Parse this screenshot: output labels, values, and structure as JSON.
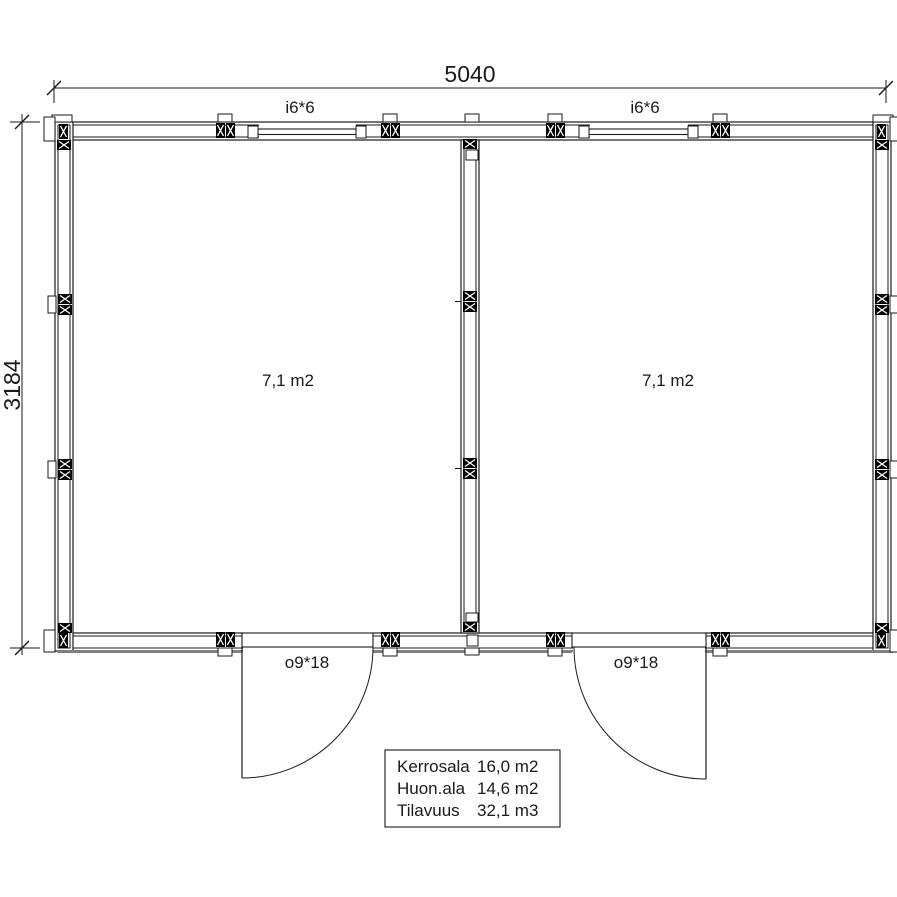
{
  "dimensions": {
    "width": "5040",
    "height": "3184"
  },
  "windows": [
    {
      "label": "i6*6"
    },
    {
      "label": "i6*6"
    }
  ],
  "doors": [
    {
      "label": "o9*18"
    },
    {
      "label": "o9*18"
    }
  ],
  "rooms": [
    {
      "area": "7,1 m2"
    },
    {
      "area": "7,1 m2"
    }
  ],
  "info_table": {
    "rows": [
      {
        "label": "Kerrosala",
        "value": "16,0 m2"
      },
      {
        "label": "Huon.ala",
        "value": "14,6 m2"
      },
      {
        "label": "Tilavuus",
        "value": "32,1 m3"
      }
    ]
  },
  "colors": {
    "line": "#1a1a1a",
    "shadow": "#808080",
    "background": "#ffffff",
    "post_fill": "#000000"
  }
}
